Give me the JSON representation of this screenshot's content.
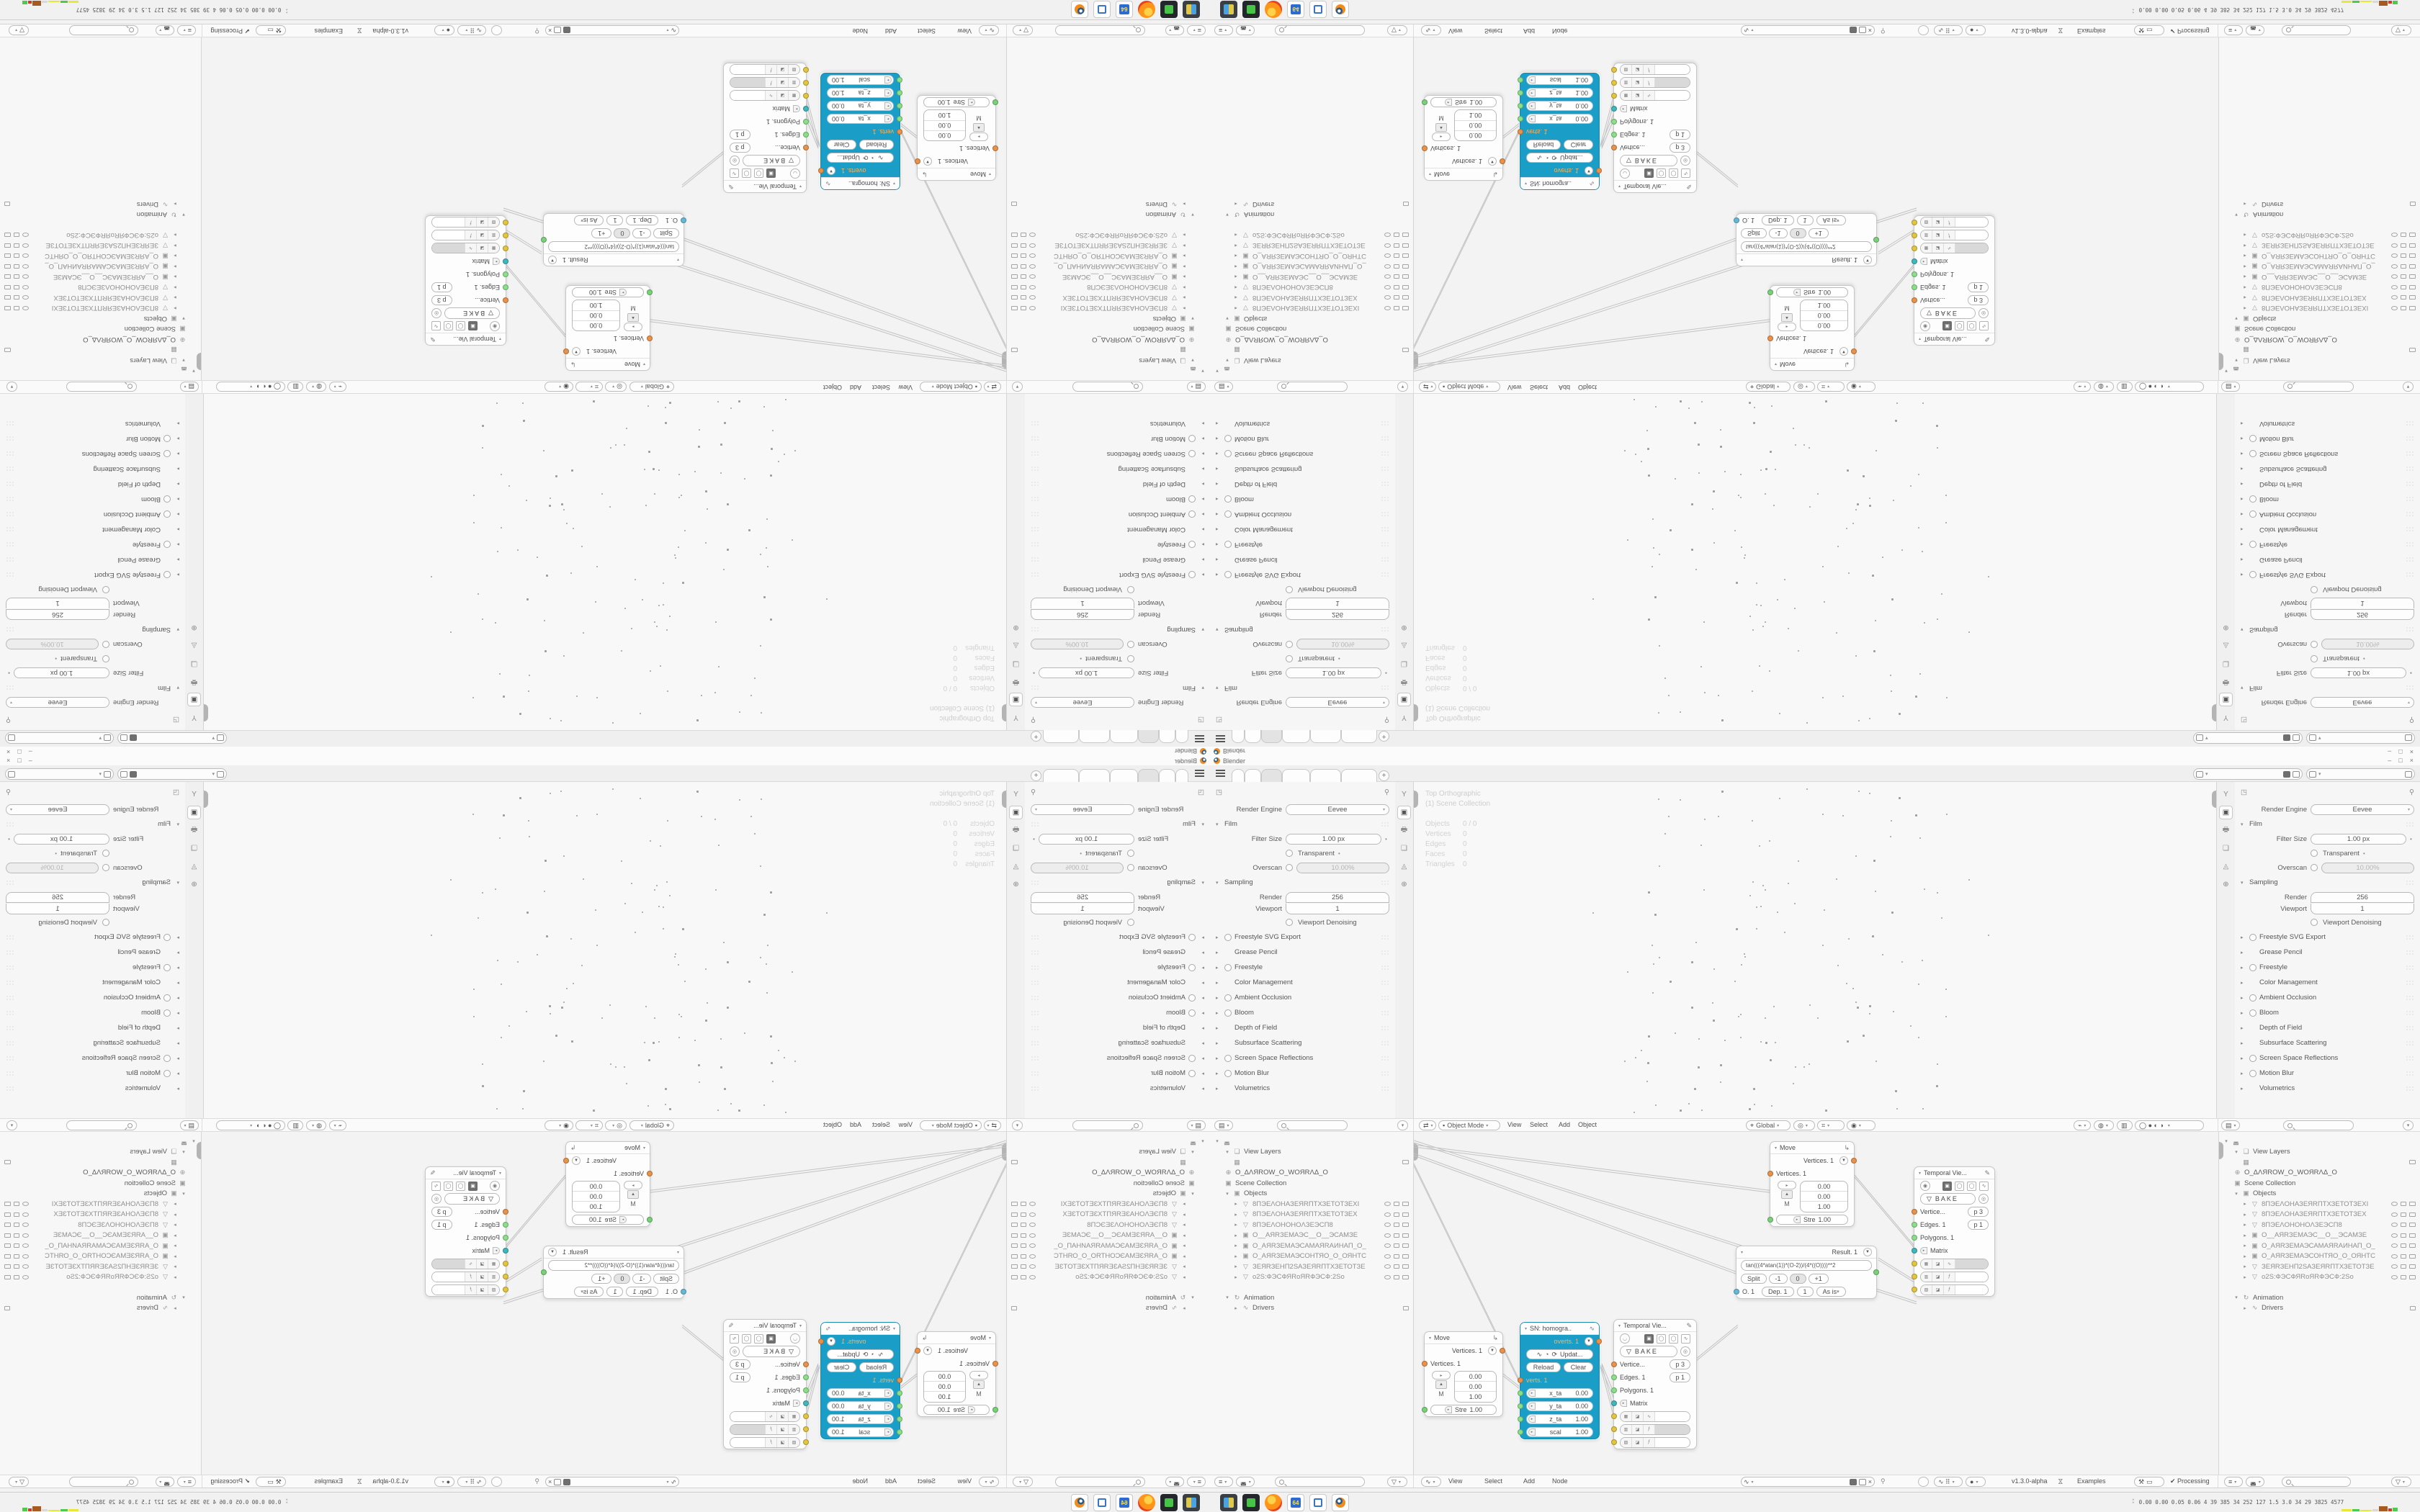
{
  "window": {
    "title": "Blender",
    "minimize": "–",
    "maximize": "□",
    "close": "×"
  },
  "topbar": {
    "new_tab": "+",
    "tab_count": 6,
    "active_tab_index": 2,
    "scene_value": "",
    "view_layer_value": ""
  },
  "props": {
    "render_engine_label": "Render Engine",
    "render_engine_value": "Eevee",
    "film": {
      "label": "Film",
      "filter_size_label": "Filter Size",
      "filter_size_value": "1.00 px",
      "transparent_label": "Transparent",
      "overscan_label": "Overscan",
      "overscan_value": "10.00%"
    },
    "sampling": {
      "label": "Sampling",
      "render_label": "Render",
      "render_value": "256",
      "viewport_label": "Viewport",
      "viewport_value": "1",
      "denoise_label": "Viewport Denoising"
    },
    "sections": [
      {
        "label": "Freestyle SVG Export",
        "cb": true
      },
      {
        "label": "Grease Pencil",
        "cb": false
      },
      {
        "label": "Freestyle",
        "cb": true
      },
      {
        "label": "Color Management",
        "cb": false
      },
      {
        "label": "Ambient Occlusion",
        "cb": true
      },
      {
        "label": "Bloom",
        "cb": true
      },
      {
        "label": "Depth of Field",
        "cb": false
      },
      {
        "label": "Subsurface Scattering",
        "cb": false
      },
      {
        "label": "Screen Space Reflections",
        "cb": true
      },
      {
        "label": "Motion Blur",
        "cb": true
      },
      {
        "label": "Volumetrics",
        "cb": false
      }
    ]
  },
  "viewport": {
    "title": "Top Orthographic",
    "subtitle": "(1) Scene Collection",
    "stats": [
      {
        "k": "Objects",
        "v": "0 / 0"
      },
      {
        "k": "Vertices",
        "v": "0"
      },
      {
        "k": "Edges",
        "v": "0"
      },
      {
        "k": "Faces",
        "v": "0"
      },
      {
        "k": "Triangles",
        "v": "0"
      }
    ],
    "header": {
      "mode": "Object Mode",
      "menu_view": "View",
      "menu_select": "Select",
      "menu_add": "Add",
      "menu_object": "Object",
      "orientation": "Global"
    }
  },
  "outliner": {
    "view_layers": "View Layers",
    "world": "O_ΔΛЯROW_O_WOЯRΛΔ_O",
    "scene_collection": "Scene Collection",
    "objects": "Objects",
    "items": [
      {
        "label": "8ПЭЕΛОНАЗЕЯRПТХЗЕТОТЗЕХI",
        "icon": "▽"
      },
      {
        "label": "8ПЭЕΛОНАЗЕЯRПТХЗЕТОТЗЕХ",
        "icon": "▽"
      },
      {
        "label": "8ПЭЕΛОНОНОΛЗЕЭСП8",
        "icon": "▽"
      },
      {
        "label": "O__АЯRЗЕМАЭС__O__ЭСАМЗЕ",
        "icon": "▣"
      },
      {
        "label": "O_АЯRЗЕМАЭСАМАЯRАИНАП_O_",
        "icon": "▣"
      },
      {
        "label": "O_АЯRЗЕМАЭСОНТЯО_O_ОЯНТС",
        "icon": "▣"
      },
      {
        "label": "ЗЕЯRЗЕНП2SАЗЕЯRПТХЗЕТОТЗЕ",
        "icon": "▽"
      },
      {
        "label": "o2S:ФЭСФЯRoЯRФЭСФ:2So",
        "icon": "▽"
      }
    ],
    "animation": "Animation",
    "drivers": "Drivers"
  },
  "node_editor": {
    "menu_view": "View",
    "menu_select": "Select",
    "menu_add": "Add",
    "menu_node": "Node",
    "version": "v1.3.0-alpha",
    "examples": "Examples",
    "processing": "Processing",
    "move": {
      "title": "Move",
      "out": "Vertices. 1",
      "in": "Vertices. 1",
      "m": "M",
      "f1": "0.00",
      "f2": "0.00",
      "f3": "1.00",
      "stre_k": "Stre",
      "stre_v": "1.00"
    },
    "sn": {
      "title": "SN: homogra..",
      "out": "overts. 1",
      "update": "Updat...",
      "reload": "Reload",
      "clear": "Clear",
      "in": "verts. 1",
      "fields": [
        {
          "k": "x_ta",
          "v": "0.00"
        },
        {
          "k": "y_ta",
          "v": "0.00"
        },
        {
          "k": "z_ta",
          "v": "1.00"
        },
        {
          "k": "scal",
          "v": "1.00"
        }
      ]
    },
    "temporal": {
      "title": "Temporal Vie...",
      "bake": "BAKE",
      "vertices_k": "Vertice...",
      "vertices_v": "p  3",
      "edges_k": "Edges. 1",
      "edges_v": "p  1",
      "polygons_k": "Polygons. 1",
      "matrix_k": "Matrix"
    },
    "formula": {
      "result": "Result. 1",
      "expr": "tan(((4*atan(1))*(O-2))/(4*((O))))**2",
      "split": "Split",
      "v1": "-1",
      "v2": "0",
      "v3": "+1",
      "out": "O. 1",
      "dep": "Dep. 1",
      "one": "1",
      "asis": "As is"
    }
  },
  "taskbar_apps": [
    "virtual-machine",
    "screen-recorder",
    "firefox",
    "file-sync",
    "screenshot-tool",
    "blender"
  ],
  "monitor": {
    "values": "0.00 0.00 0.05 0.06    4    39   385    34   252   127   1.5   3.0   34   29   3825 4577"
  }
}
